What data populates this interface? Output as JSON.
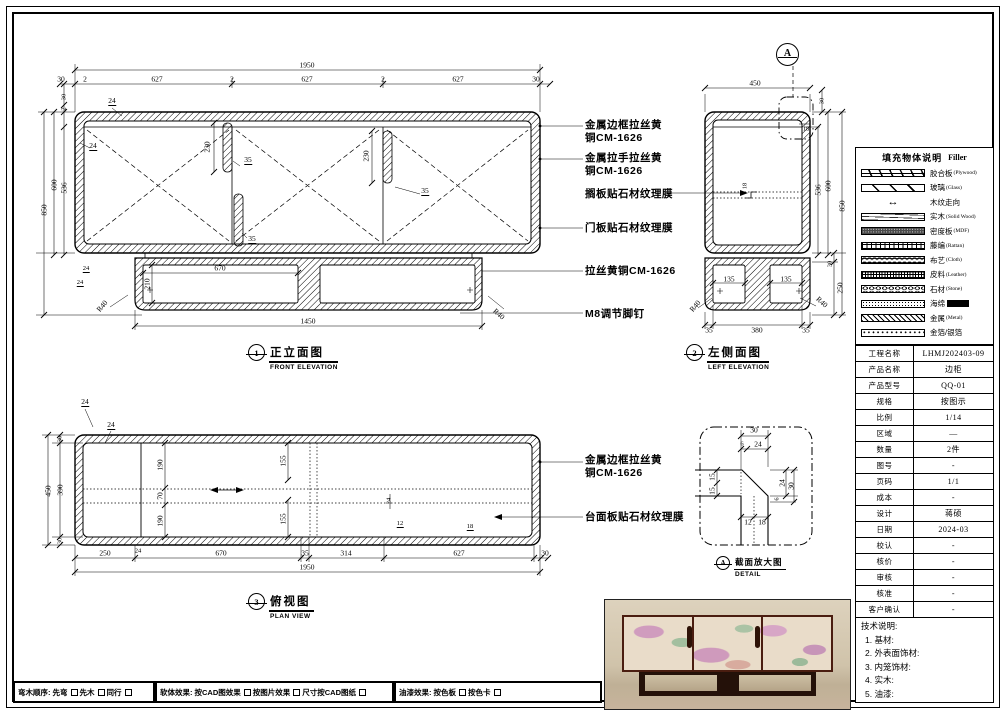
{
  "colors": {
    "line": "#000000",
    "paper": "#ffffff"
  },
  "front_view": {
    "marker": "1",
    "title": "正立面图",
    "subtitle": "FRONT ELEVATION",
    "dim_total_w": "1950",
    "dims_top": [
      "30",
      "2",
      "627",
      "2",
      "627",
      "2",
      "627",
      "30"
    ],
    "dim_850": "850",
    "dim_600": "600",
    "dim_536": "536",
    "dim_top30": "30",
    "dim_top2": "2",
    "dim_t24a": "24",
    "dim_t24b": "24",
    "dim_h230a": "230",
    "dim_h35a": "35",
    "dim_h35b": "35",
    "dim_h230b": "230",
    "dim_h35c": "35",
    "dim_670": "670",
    "dim_210": "210",
    "dim_1450": "1450",
    "dim_r40l": "R40",
    "dim_r40r": "R40",
    "dim_b24a": "24",
    "dim_b24b": "24"
  },
  "left_view": {
    "marker": "2",
    "title": "左侧面图",
    "subtitle": "LEFT ELEVATION",
    "detail_marker": "A",
    "dim_450": "450",
    "dim_top30": "30",
    "dim_18a": "18",
    "dim_18b": "18",
    "dim_536": "536",
    "dim_600": "600",
    "dim_850": "850",
    "dim_30": "30",
    "dim_250": "250",
    "dim_135a": "135",
    "dim_135b": "135",
    "dim_r40l": "R40",
    "dim_r40r": "R40",
    "dims_bottom": [
      "35",
      "380",
      "35"
    ]
  },
  "plan_view": {
    "marker": "3",
    "title": "俯视图",
    "subtitle": "PLAN VIEW",
    "dim_24a": "24",
    "dim_24b": "24",
    "dim_450": "450",
    "dim_390": "390",
    "dim_30a": "30",
    "dim_30b": "30",
    "dim_190a": "190",
    "dim_70": "70",
    "dim_190b": "190",
    "dim_155a": "155",
    "dim_155b": "155",
    "dim_24c": "24",
    "dim_12": "12",
    "dim_18": "18",
    "dims_bottom": [
      "250",
      "24",
      "670",
      "35",
      "314",
      "627",
      "30"
    ],
    "dim_total": "1950"
  },
  "detail_view": {
    "marker": "A",
    "title": "截面放大图",
    "subtitle": "DETAIL",
    "dim_30t": "30",
    "dim_6t": "6",
    "dim_24t": "24",
    "dim_15a": "15",
    "dim_15b": "15",
    "dim_24r": "24",
    "dim_30r": "30",
    "dim_6r": "6",
    "dim_12": "12",
    "dim_18": "18"
  },
  "callouts": {
    "front": [
      {
        "line1": "金属边框拉丝黄",
        "line2": "铜CM-1626"
      },
      {
        "line1": "金属拉手拉丝黄",
        "line2": "铜CM-1626"
      },
      {
        "line1": "搁板贴石材纹理膜"
      },
      {
        "line1": "门板贴石材纹理膜"
      },
      {
        "line1": "拉丝黄铜CM-1626"
      },
      {
        "line1": "M8调节脚钉"
      }
    ],
    "plan": [
      {
        "line1": "金属边框拉丝黄",
        "line2": "铜CM-1626"
      },
      {
        "line1": "台面板贴石材纹理膜"
      }
    ]
  },
  "legend": {
    "title": "填充物体说明",
    "title_en": "Filler",
    "grain_arrow_icon": "↔",
    "items": [
      {
        "label": "胶合板",
        "en": "(Plywood)"
      },
      {
        "label": "玻璃",
        "en": "(Glass)"
      },
      {
        "label": "木纹走向",
        "en": ""
      },
      {
        "label": "实木",
        "en": "(Solid Wood)"
      },
      {
        "label": "密度板",
        "en": "(MDF)"
      },
      {
        "label": "藤编",
        "en": "(Rattan)"
      },
      {
        "label": "布艺",
        "en": "(Cloth)"
      },
      {
        "label": "皮料",
        "en": "(Leather)"
      },
      {
        "label": "石材",
        "en": "(Stone)"
      },
      {
        "label": "海绵",
        "en": ""
      },
      {
        "label": "金属",
        "en": "(Metal)"
      },
      {
        "label": "金箔/银箔",
        "en": ""
      }
    ]
  },
  "title_block": {
    "rows": [
      {
        "label": "工程名称",
        "value": "LHMJ202403-09"
      },
      {
        "label": "产品名称",
        "value": "边柜"
      },
      {
        "label": "产品型号",
        "value": "QQ-01"
      },
      {
        "label": "规格",
        "value": "按图示"
      },
      {
        "label": "比例",
        "value": "1/14"
      },
      {
        "label": "区域",
        "value": "—"
      },
      {
        "label": "数量",
        "value": "2件"
      },
      {
        "label": "图号",
        "value": "-"
      },
      {
        "label": "页码",
        "value": "1/1"
      },
      {
        "label": "成本",
        "value": "-"
      },
      {
        "label": "设计",
        "value": "蒋硕"
      },
      {
        "label": "日期",
        "value": "2024-03"
      },
      {
        "label": "校认",
        "value": "-"
      },
      {
        "label": "核价",
        "value": "-"
      },
      {
        "label": "审核",
        "value": "-"
      },
      {
        "label": "核准",
        "value": "-"
      },
      {
        "label": "客户确认",
        "value": "-"
      }
    ]
  },
  "tech_notes": {
    "title": "技术说明:",
    "items": [
      "1. 基材:",
      "2. 外表面饰材:",
      "3. 内笼饰材:",
      "4. 实木:",
      "5. 油漆:"
    ]
  },
  "footer": {
    "group1": {
      "label": "弯木顺序:",
      "options": [
        "先弯",
        "先木",
        "同行"
      ]
    },
    "group2": {
      "label": "软体效果:",
      "options": [
        "按CAD图效果",
        "按图片效果",
        "尺寸按CAD图纸"
      ]
    },
    "group3": {
      "label": "油漆效果:",
      "options": [
        "按色板",
        "按色卡"
      ]
    }
  }
}
